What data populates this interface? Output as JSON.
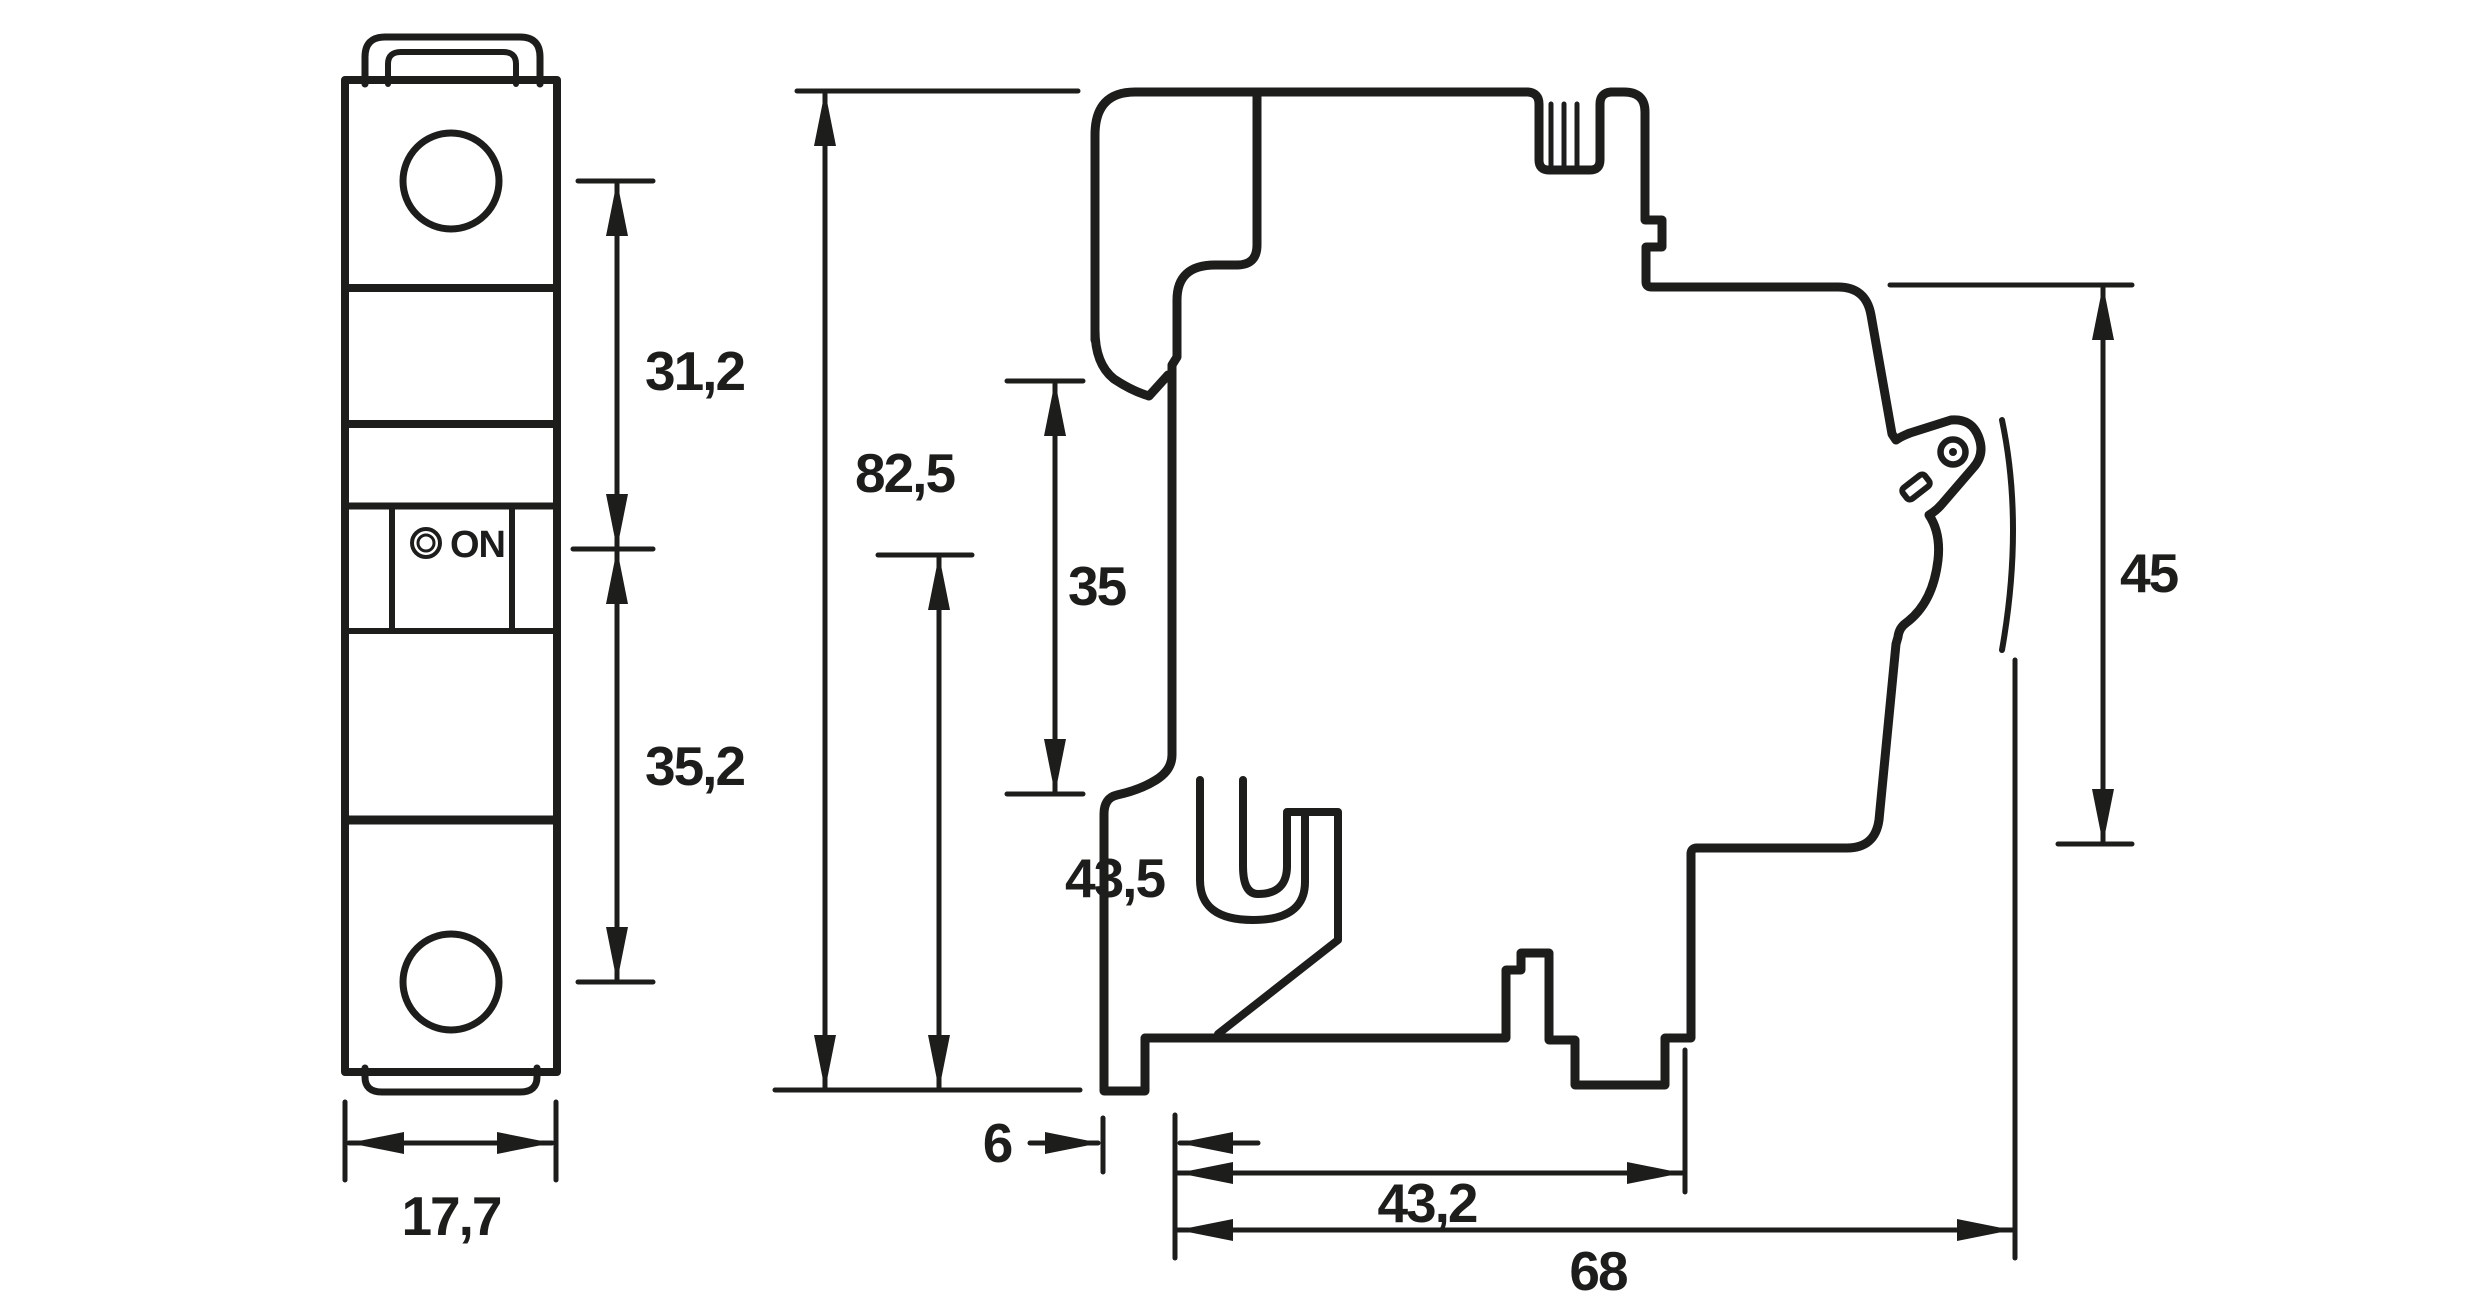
{
  "drawing": {
    "type": "technical-dimension-drawing",
    "subject": "miniature-circuit-breaker-front-and-side-views",
    "background_color": "#ffffff",
    "line_color": "#1d1d1b",
    "unit_style": "decimal-comma-millimeters",
    "front_view": {
      "switch_label": "ON",
      "dim_31_2": "31,2",
      "dim_35_2": "35,2",
      "dim_17_7": "17,7"
    },
    "side_view": {
      "dim_82_5": "82,5",
      "dim_43_5": "43,5",
      "dim_35": "35",
      "dim_45": "45",
      "dim_6": "6",
      "dim_43_2": "43,2",
      "dim_68": "68"
    }
  }
}
